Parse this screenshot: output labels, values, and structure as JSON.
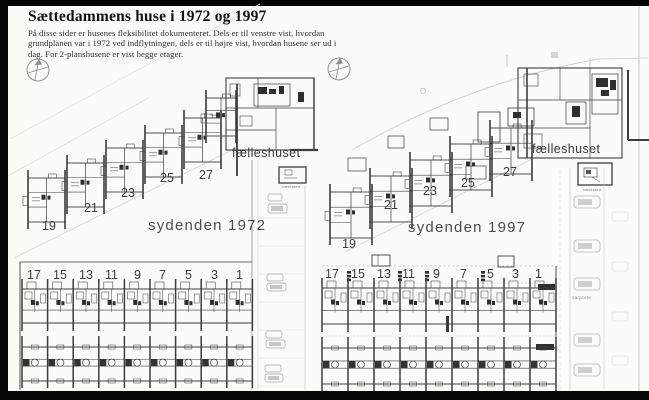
{
  "header": {
    "title": "Sættedammens huse i 1972 og 1997",
    "intro_lines": [
      "På disse sider er husenes fleksibilitet dokumenteret. Dels er til venstre vist, hvordan",
      "grundplanen var i 1972 ved indflytningen, dels er til højre vist, hvordan husene ser ud i",
      "dag. For 2-planshusene er vist begge etager."
    ]
  },
  "plans": [
    {
      "area_label": "sydenden 1972",
      "common_house_label": "fælleshuset",
      "outbuilding_label": "værksted",
      "odd_numbers_diagonal": [
        "19",
        "21",
        "23",
        "25",
        "27"
      ],
      "odd_numbers_row": [
        "17",
        "15",
        "13",
        "11",
        "9",
        "7",
        "5",
        "3",
        "1"
      ]
    },
    {
      "area_label": "sydenden 1997",
      "common_house_label": "fælleshuset",
      "outbuilding_label": "værksted",
      "carport_label": "carporte",
      "odd_numbers_diagonal": [
        "19",
        "21",
        "23",
        "25",
        "27"
      ],
      "odd_numbers_row": [
        "17",
        "15",
        "13",
        "11",
        "9",
        "7",
        "5",
        "3",
        "1"
      ]
    }
  ]
}
